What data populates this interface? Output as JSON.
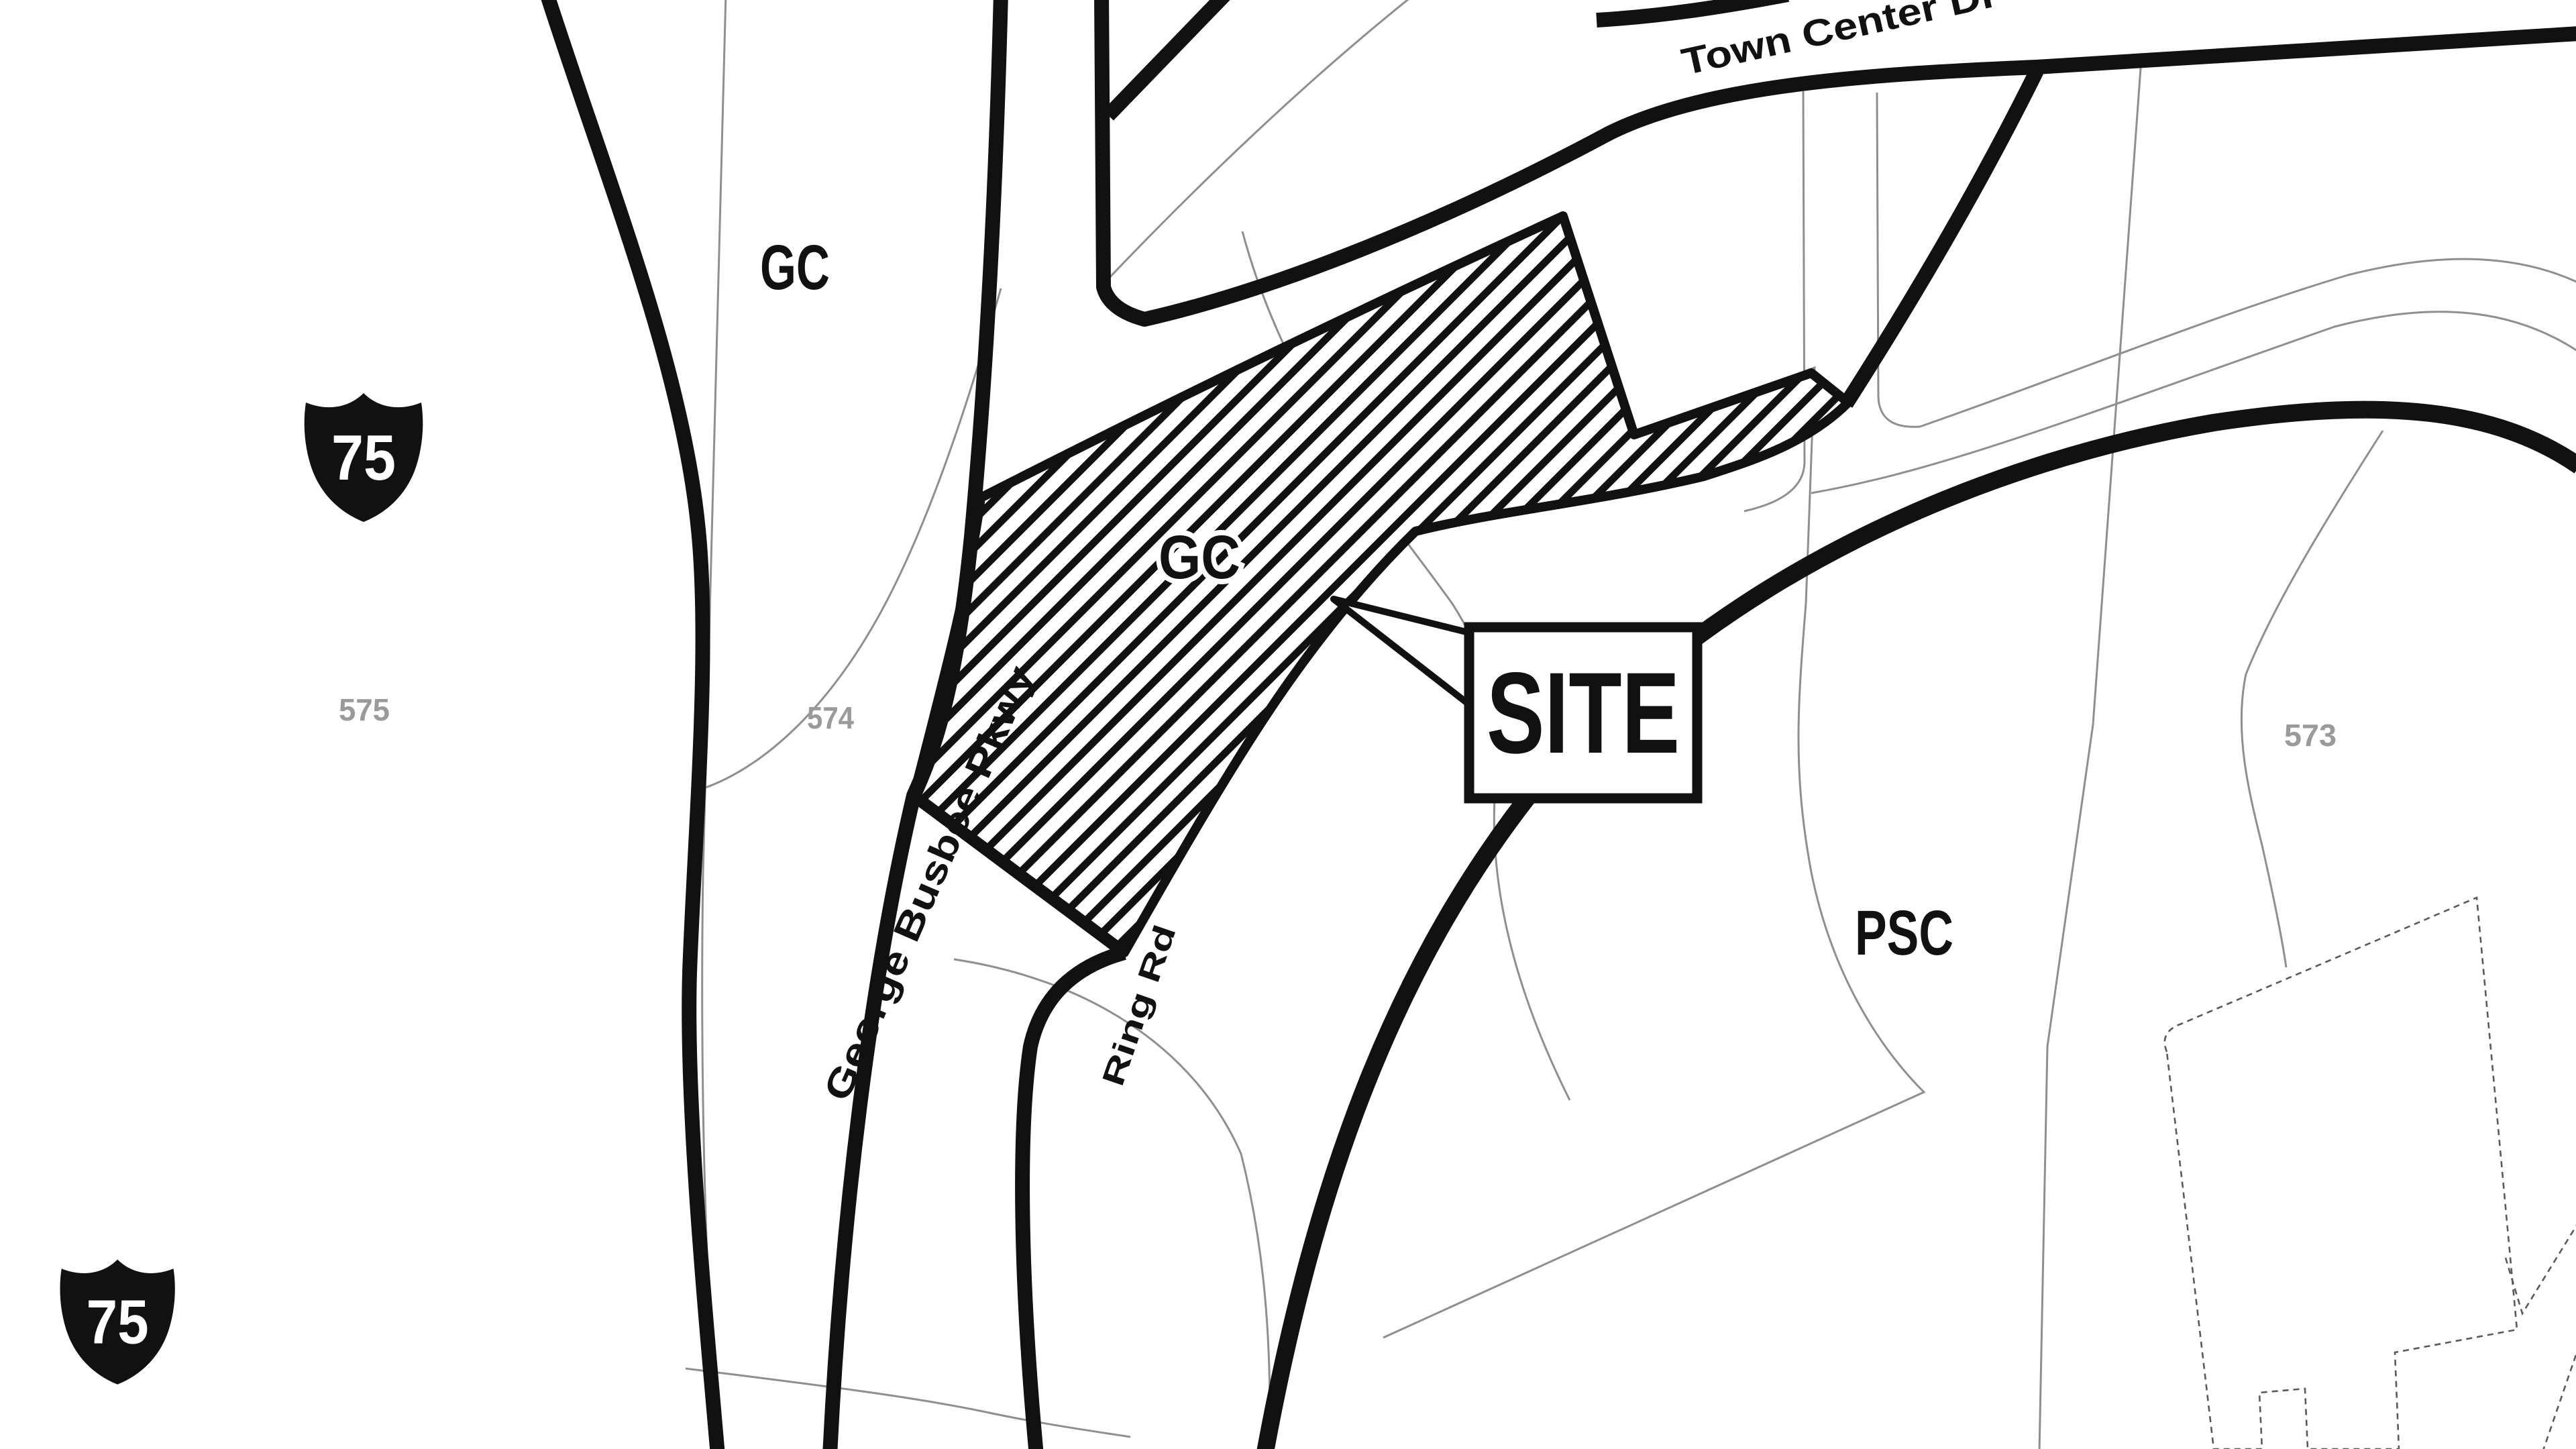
{
  "map": {
    "type": "zoning-site-location-map",
    "labels": {
      "road_town_center": "Town Center Dr",
      "road_busbee": "George Busbee Pkwy",
      "road_ring": "Ring Rd",
      "zone_gc_upper": "GC",
      "zone_gc_site": "GC",
      "zone_psc": "PSC",
      "site_callout": "SITE",
      "parcel_575": "575",
      "parcel_574": "574",
      "parcel_573": "573",
      "shield_75_top": "75",
      "shield_75_bottom": "75"
    },
    "colors": {
      "background": "#ffffff",
      "road_line": "#111111",
      "thin_parcel_line": "#8f8f8f",
      "building_outline": "#5a5a5a",
      "parcel_number_text": "#9a9a9a",
      "label_text": "#111111",
      "shield_fill": "#111111",
      "shield_number": "#ffffff",
      "site_hatch": "#111111"
    }
  }
}
